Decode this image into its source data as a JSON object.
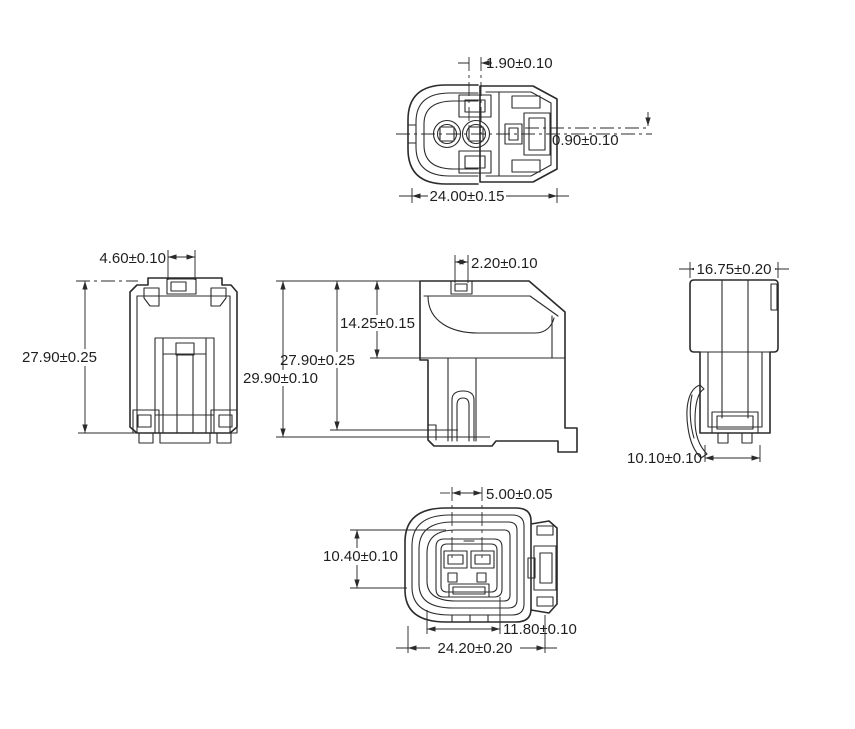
{
  "drawing": {
    "kind": "connector-engineering-drawing",
    "line_color": "#2b2b2b",
    "background_color": "#ffffff",
    "views": {
      "top": {
        "dims": {
          "terminal_offset": "1.90±0.10",
          "center_offset": "0.90±0.10",
          "overall_width": "24.00±0.15"
        }
      },
      "front": {
        "dims": {
          "latch_width": "4.60±0.10",
          "body_height": "27.90±0.25"
        }
      },
      "side": {
        "dims": {
          "tab_width": "2.20±0.10",
          "upper_height": "14.25±0.15",
          "body_height": "27.90±0.25",
          "overall_height": "29.90±0.10"
        }
      },
      "rear": {
        "dims": {
          "body_width": "16.75±0.20",
          "base_width": "10.10±0.10"
        }
      },
      "bottom": {
        "dims": {
          "terminal_pitch": "5.00±0.05",
          "cavity_height": "10.40±0.10",
          "inner_width": "11.80±0.10",
          "overall_width": "24.20±0.20"
        }
      }
    }
  }
}
